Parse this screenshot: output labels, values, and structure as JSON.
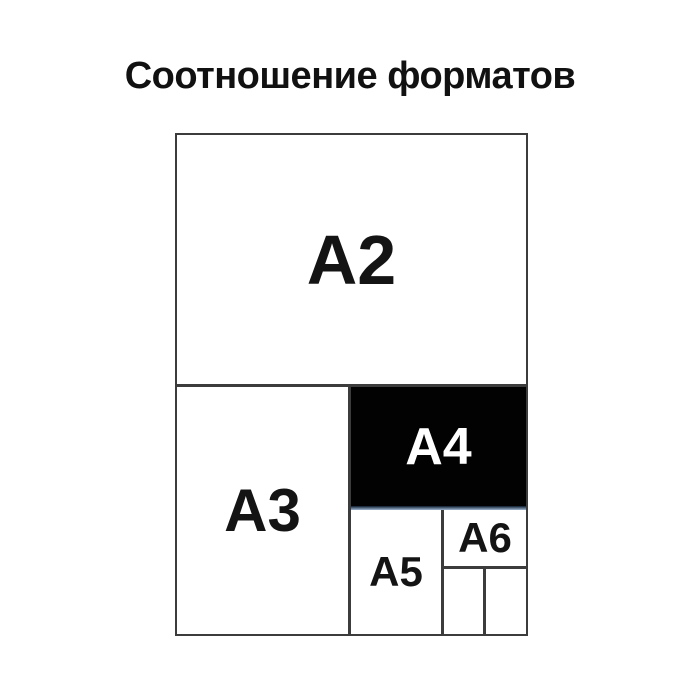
{
  "title": "Соотношение форматов",
  "diagram": {
    "description_visible_labels_only": "nested paper format comparison",
    "cells": {
      "a2": "A2",
      "a3": "A3",
      "a4": "A4",
      "a5": "A5",
      "a6": "A6"
    }
  },
  "colors": {
    "background": "#ffffff",
    "line": "#3c3c3c",
    "title_text": "#111111",
    "label_text": "#141414",
    "a4_background": "#020202",
    "a4_text": "#ffffff",
    "a4_bottom_edge_dark": "#0c1a2c",
    "a4_bottom_edge_light": "#9fb9d4"
  }
}
